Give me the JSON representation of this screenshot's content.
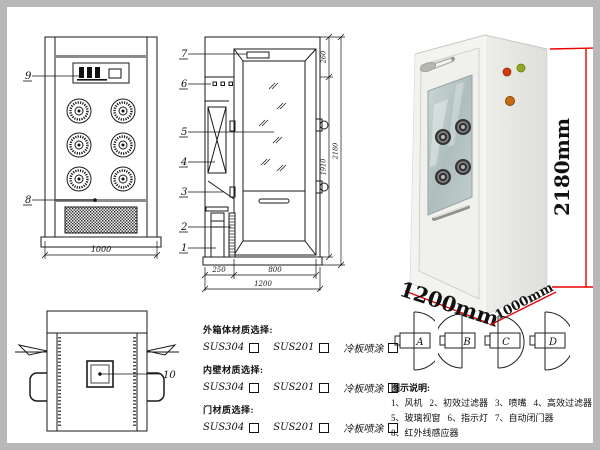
{
  "front_view": {
    "callout_panel": "9",
    "callout_grille": "8",
    "dim_width": "1000"
  },
  "side_view": {
    "callouts": [
      "7",
      "6",
      "5",
      "4",
      "3",
      "2",
      "1"
    ],
    "dim_top": "260",
    "dim_door_height": "1910",
    "dim_total_height": "2180",
    "dim_left_depth": "250",
    "dim_door_width": "800",
    "dim_total_width": "1200"
  },
  "top_view": {
    "callout_lamp": "10"
  },
  "photo": {
    "dim_height": "2180mm",
    "dim_width": "1200mm",
    "dim_depth": "1000mm",
    "accent_color": "#ee0000"
  },
  "door_configs": {
    "labels": [
      "A",
      "B",
      "C",
      "D"
    ]
  },
  "materials": {
    "groups": [
      {
        "label": "外箱体材质选择:",
        "options": [
          "SUS304",
          "SUS201",
          "冷板喷涂"
        ]
      },
      {
        "label": "内壁材质选择:",
        "options": [
          "SUS304",
          "SUS201",
          "冷板喷涂"
        ]
      },
      {
        "label": "门材质选择:",
        "options": [
          "SUS304",
          "SUS201",
          "冷板喷涂"
        ]
      }
    ]
  },
  "legend": {
    "title": "图示说明:",
    "rows": [
      [
        "1、风机",
        "2、初效过滤器",
        "3、喷嘴",
        "4、高效过滤器"
      ],
      [
        "5、玻璃视窗",
        "6、指示灯",
        "7、自动闭门器",
        "8、红外线感应器"
      ],
      [
        "9、控制面板",
        "10、照明灯"
      ]
    ]
  }
}
